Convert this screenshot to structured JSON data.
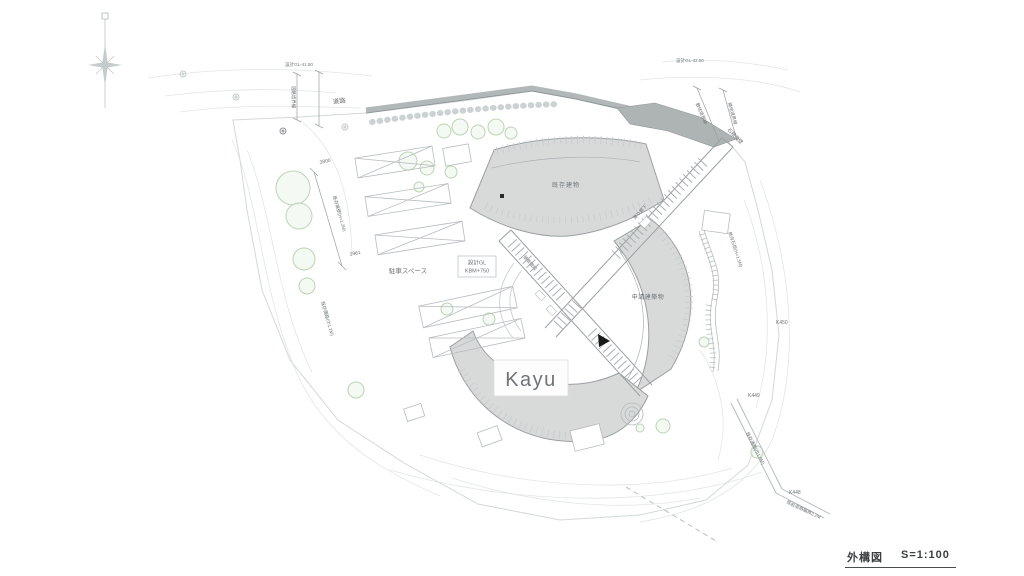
{
  "title_block": {
    "name": "外構図",
    "scale": "S=1:100"
  },
  "labels": {
    "kayu": "Kayu",
    "building_top": "既存建物",
    "building_middle": "申請建築物",
    "parking": "駐車スペース",
    "gl_box_line1": "設計GL",
    "gl_box_line2": "KBM+750",
    "road": "道路",
    "masonry_wall": "石積擁壁",
    "boundary_site": "敷地境界線",
    "boundary_neighbor": "隣地境界線",
    "boundary_road": "道路境界線",
    "corridor": "渡り廊下",
    "stairs": "鉄骨階段",
    "existing_path": "既存通路(巾1.8M)",
    "existing_stone": "既存石垣(H=1.5M)",
    "road_width": "既設道路幅員2.2M",
    "wall_left": "既存擁壁(H=1.2M)",
    "path_left": "既存園路(巾1.2M)",
    "gl_left": "設計GL-41.50",
    "gl_right": "設計GL-42.50"
  },
  "benchmarks": {
    "k449": "K449",
    "k450": "K450",
    "k448": "K448"
  },
  "dimensions": {
    "d1": "3900",
    "d2": "3961"
  },
  "colors": {
    "line": "#b9bfc1",
    "line_light": "#e0e4e4",
    "building_fill": "#d8dada",
    "road_fill": "#aeb4b4",
    "tree": "#bcd4b4",
    "text": "#5a5f61",
    "red": "#d2695c"
  }
}
